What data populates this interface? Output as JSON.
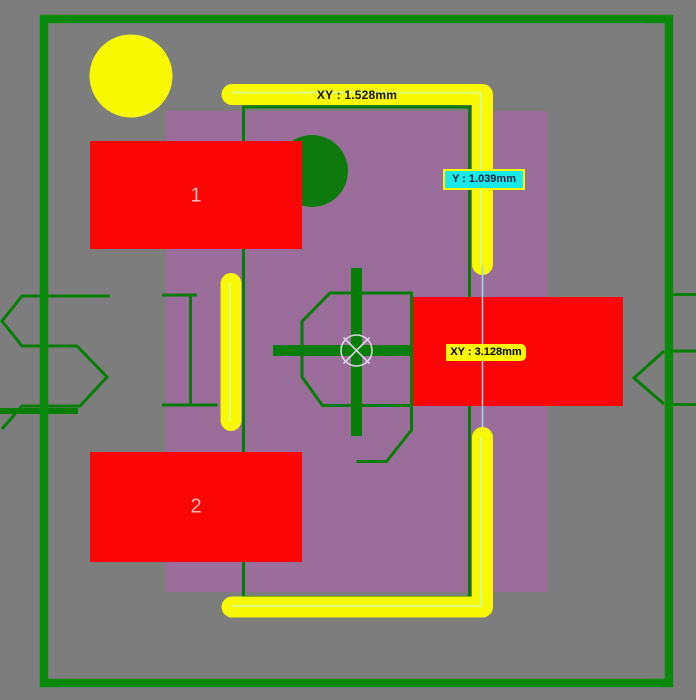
{
  "canvas": {
    "description": "PCB footprint editor canvas"
  },
  "dimensions": {
    "top": "XY : 1.528mm",
    "y": "Y : 1.039mm",
    "xy": "XY : 3.128mm"
  },
  "pads": [
    {
      "number": "1"
    },
    {
      "number": "2"
    },
    {
      "number": ""
    }
  ],
  "colors": {
    "background": "#7d7d7d",
    "board-green": "#0a8a0a",
    "line-green": "#067d06",
    "dark-green": "#0e7a0e",
    "silk-yellow": "#f8f800",
    "silk-centerline": "#ddff7f",
    "pad-red": "#fb0505",
    "pad-number": "#ffb9b9",
    "body-purple": "#9a6d9a",
    "highlight-cyan": "#19e8e8",
    "measure-cyan": "#9adce8",
    "label-text-dark": "#0b2040",
    "origin-white": "#e6def0"
  }
}
